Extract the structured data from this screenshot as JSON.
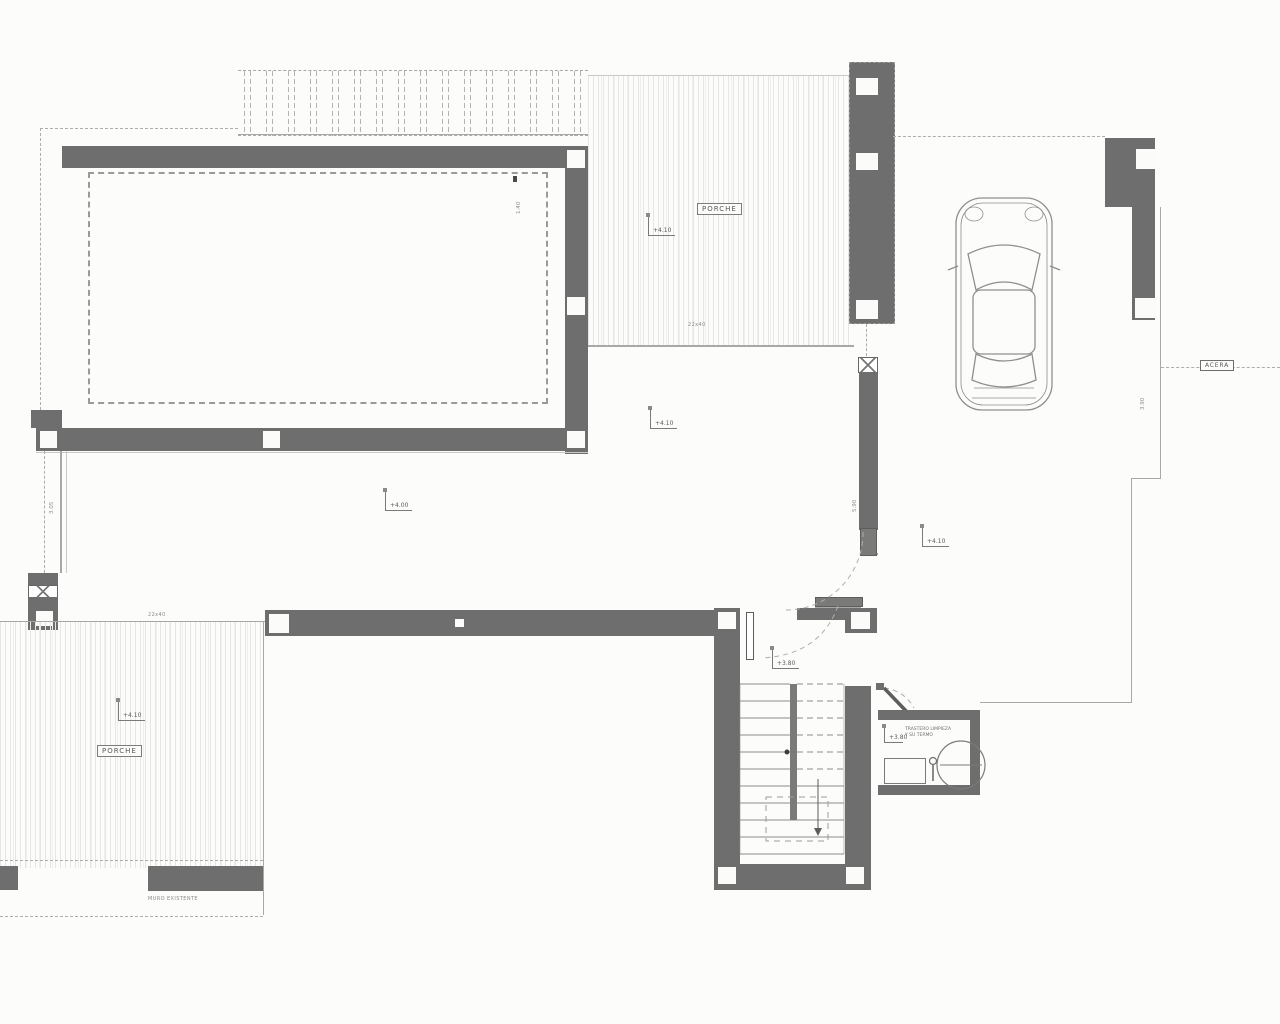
{
  "floorplan": {
    "labels": {
      "porch_top": "PORCHE",
      "porch_bottom": "PORCHE",
      "sidewalk": "ACERA",
      "wall_note": "MURO EXISTENTE",
      "utility_note_1": "TRASTERO LIMPIEZA",
      "utility_note_2": "Y SU TERMO",
      "porch_top_paving": "22x40",
      "porch_bottom_paving": "22x40"
    },
    "levels": [
      {
        "name": "porch-top",
        "value": "+4.10"
      },
      {
        "name": "living-upper",
        "value": "+4.10"
      },
      {
        "name": "living-center",
        "value": "+4.00"
      },
      {
        "name": "hall-right",
        "value": "+4.10"
      },
      {
        "name": "porch-bottom",
        "value": "+4.10"
      },
      {
        "name": "stair-landing",
        "value": "+3.80"
      },
      {
        "name": "utility-room",
        "value": "+3.80"
      }
    ],
    "dimensions": {
      "pool_edge": "1.40",
      "side_passage": "3.05",
      "wall_length": "5.90",
      "street_level": "3.90"
    },
    "colors": {
      "wall_gray": "#6e6e6e",
      "line_gray": "#a8a8a6",
      "background": "#fcfcfa"
    }
  }
}
